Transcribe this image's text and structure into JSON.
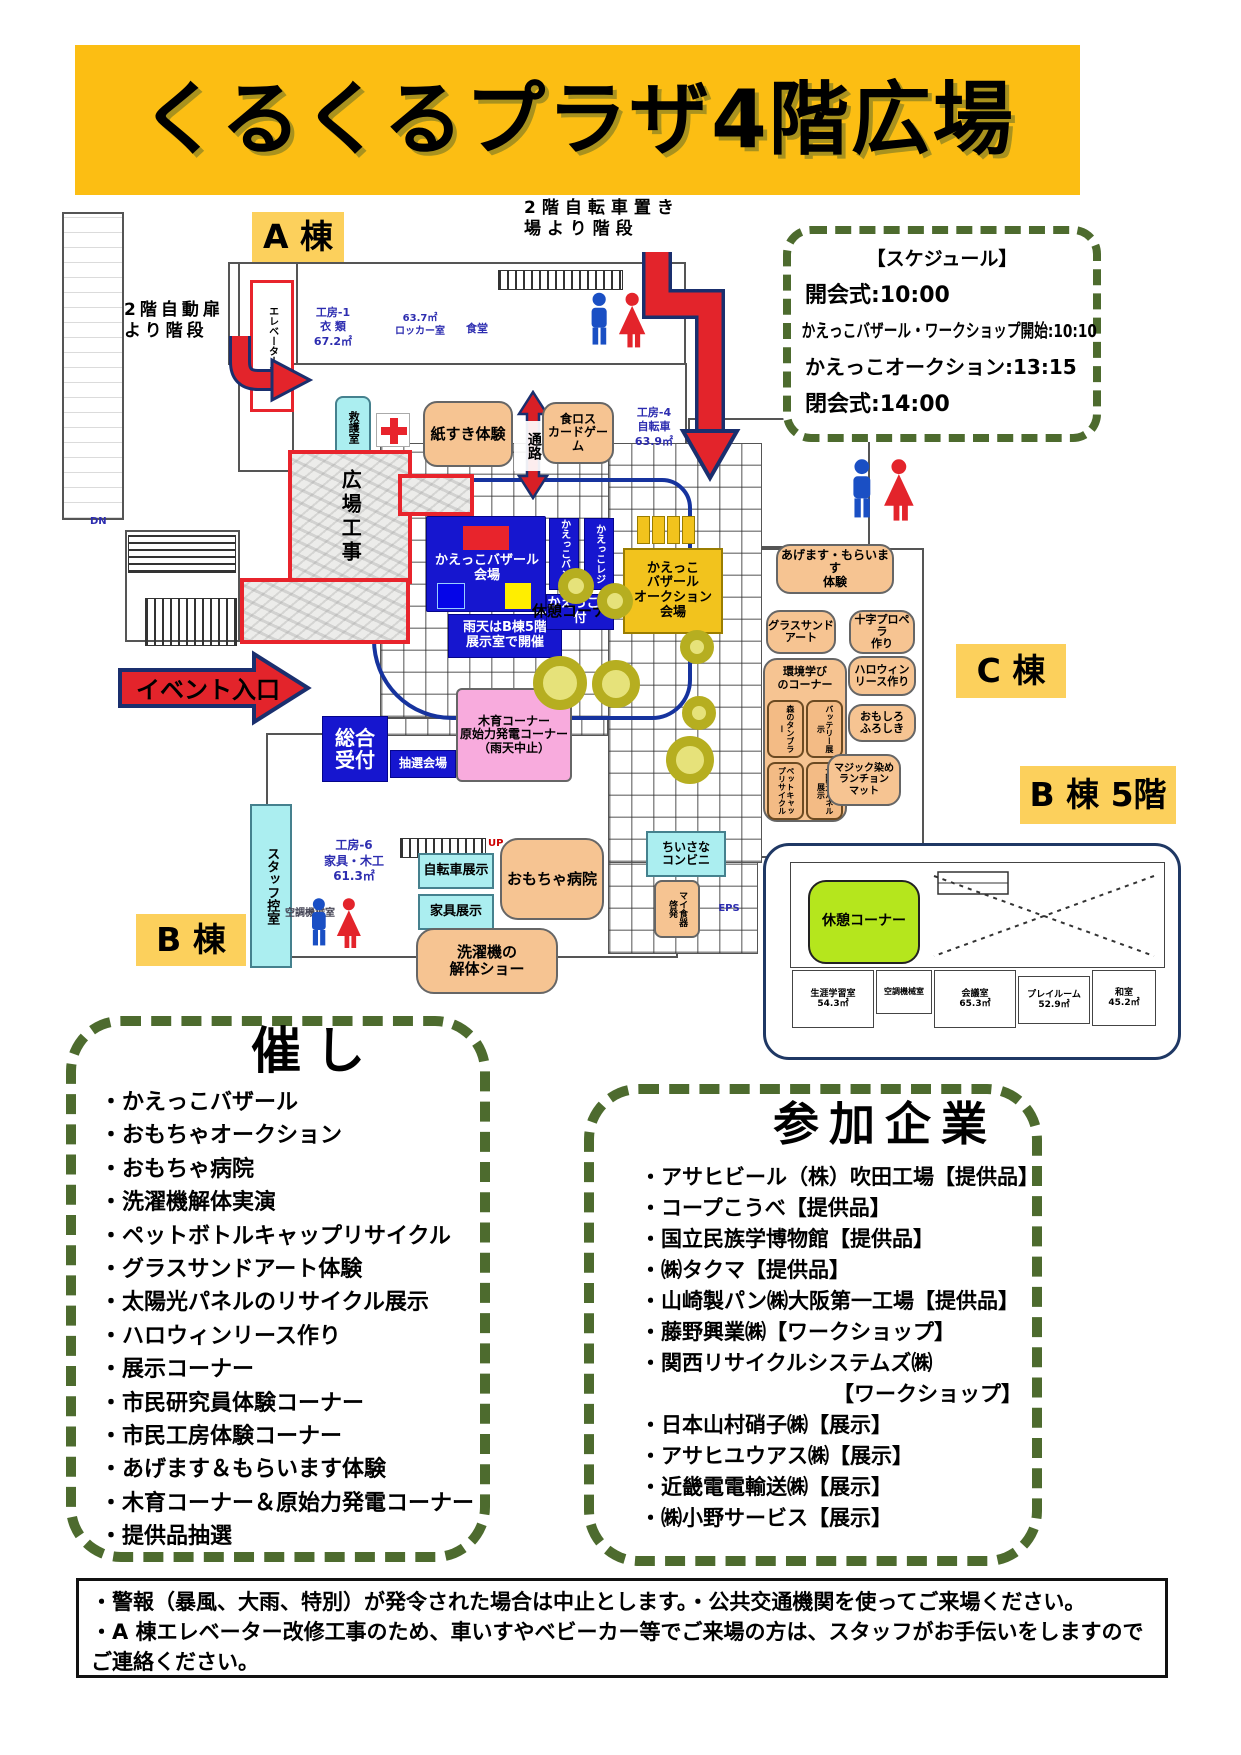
{
  "title": "くるくるプラザ4階広場",
  "schedule": {
    "heading": "【スケジュール】",
    "line1": "開会式:10:00",
    "line2": "かえっこバザール・ワークショップ開始:10:10",
    "line3": "かえっこオークション:13:15",
    "line4": "閉会式:14:00"
  },
  "labels": {
    "wing_a": "A 棟",
    "wing_b": "B 棟",
    "wing_c": "C 棟",
    "wing_b5": "B 棟 5階"
  },
  "annotations": {
    "stairs_bike": "2階自転車置き\n場より階段",
    "stairs_door": "2階自動扉\nより階段",
    "entrance": "イベント入口",
    "corridor": "通路",
    "rest_main": "休憩コーナー"
  },
  "areas": {
    "elevator": "エレベーター工事",
    "first_aid": "救護室",
    "paper": "紙すき体験",
    "foodloss": "食ロス\nカードゲーム",
    "plaza_construction": "広場工事",
    "bazaar": "かえっこバザール\n会場",
    "rainy": "雨天はB棟5階\n展示室で開催",
    "bank": "かえっこバンク",
    "cashier": "かえっこレジ",
    "kaekko_reception": "かえっこ受付",
    "auction": "かえっこ\nバザール\nオークション\n会場",
    "give_get": "あげます・もらいます\n体験",
    "glass_sand": "グラスサンド\nアート",
    "propeller": "十字プロペラ\n作り",
    "eco_corner": "環境学び\nのコーナー",
    "tumbler": "森のタンブラー",
    "battery": "バッテリー展示",
    "petcap": "ペットキャップリサイクル",
    "solar": "太陽光パネル展示",
    "halloween": "ハロウィン\nリース作り",
    "furoshiki": "おもしろ\nふろしき",
    "magic_mat": "マジック染め\nランチョン\nマット",
    "wood": "木育コーナー\n原始力発電コーナー\n（雨天中止）",
    "main_reception": "総合\n受付",
    "lottery": "抽選会場",
    "staff_room": "スタッフ控室",
    "bike_show": "自転車展示",
    "furniture_show": "家具展示",
    "toy_hospital": "おもちゃ病院",
    "mini_store": "ちいさな\nコンビニ",
    "my_dishes": "マイ食器\n啓発",
    "washer_show": "洗濯機の\n解体ショー",
    "rest_b5": "休憩コーナー"
  },
  "rooms": {
    "kobo1": "工房-1\n衣 類\n67.2㎡",
    "locker": "63.7㎡\nロッカー室",
    "dining": "食堂",
    "kobo4": "工房-4\n自転車\n63.9㎡",
    "kobo6": "工房-6\n家具・木工\n61.3㎡",
    "kucho_b": "空調機械室",
    "eps": "EPS",
    "up": "UP",
    "dn": "DN",
    "b5_study": "生涯学習室\n54.3㎡",
    "b5_kucho": "空調機械室",
    "b5_meeting": "会議室\n65.3㎡",
    "b5_play": "プレイルーム\n52.9㎡",
    "b5_washitsu": "和室\n45.2㎡"
  },
  "events": {
    "heading": "催し",
    "items": [
      "・かえっこバザール",
      "・おもちゃオークション",
      "・おもちゃ病院",
      "・洗濯機解体実演",
      "・ペットボトルキャップリサイクル",
      "・グラスサンドアート体験",
      "・太陽光パネルのリサイクル展示",
      "・ハロウィンリース作り",
      "・展示コーナー",
      "・市民研究員体験コーナー",
      "・市民工房体験コーナー",
      "・あげます＆もらいます体験",
      "・木育コーナー＆原始力発電コーナー",
      "・提供品抽選"
    ]
  },
  "companies": {
    "heading": "参加企業",
    "items": [
      "・アサヒビール（株）吹田工場【提供品】",
      "・コープこうべ【提供品】",
      "・国立民族学博物館【提供品】",
      "・㈱タクマ【提供品】",
      "・山崎製パン㈱大阪第一工場【提供品】",
      "・藤野興業㈱【ワークショップ】",
      "・関西リサイクルシステムズ㈱",
      "【ワークショップ】",
      "・日本山村硝子㈱【展示】",
      "・アサヒユウアス㈱【展示】",
      "・近畿電電輸送㈱【展示】",
      "・㈱小野サービス【展示】"
    ]
  },
  "notice": {
    "line1": "・警報（暴風、大雨、特別）が発令された場合は中止とします。・公共交通機関を使ってご来場ください。",
    "line2": "・A 棟エレベーター改修工事のため、車いすやベビーカー等でご来場の方は、スタッフがお手伝いをしますのでご連絡ください。"
  },
  "colors": {
    "banner": "#FCBE13",
    "dash_green": "#4D6B2E",
    "blue_box": "#1616CF",
    "orange_box": "#F6C492",
    "cyan_box": "#ABEEF0",
    "gold_box": "#F2C31D",
    "pink_box": "#F8ABDD",
    "lime_box": "#B5E61D",
    "red": "#E8242C",
    "label_yellow": "#FCD05C"
  }
}
